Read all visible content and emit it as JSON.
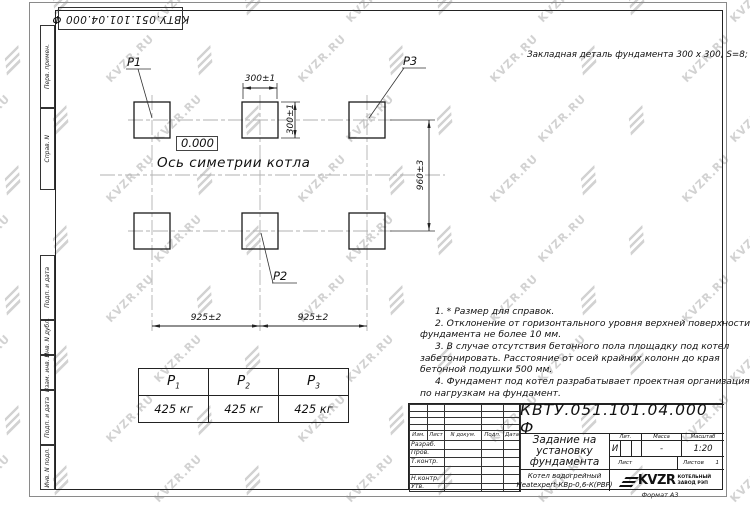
{
  "sheet": {
    "watermark": "KVZR.RU",
    "format": "Формат А3"
  },
  "top_stamp": "КВТУ.051.101.04.000  Ф",
  "margins": {
    "top": [
      "Перв. примен.",
      "Справ. N"
    ],
    "bottom": [
      "Подп. и дата",
      "Инв. N дубл.",
      "Взам. инв. N",
      "Подп. и дата",
      "Инв. N подл."
    ]
  },
  "drawing": {
    "header_note": "Закладная деталь фундамента  300 x 300,  S=8;",
    "elevation": "0.000",
    "axis_label": "Ось симетрии котла",
    "p1": "P1",
    "p2": "P2",
    "p3": "P3",
    "dim_pad_width": "300±1",
    "dim_pad_height": "300±1",
    "dim_rows": "960±3",
    "dim_col_left": "925±2",
    "dim_col_right": "925±2"
  },
  "load_table": {
    "headers": [
      {
        "b": "P",
        "s": "1"
      },
      {
        "b": "P",
        "s": "2"
      },
      {
        "b": "P",
        "s": "3"
      }
    ],
    "values": [
      "425 кг",
      "425 кг",
      "425 кг"
    ]
  },
  "notes": [
    "1. * Размер для справок.",
    "2. Отклонение от горизонтального уровня верхней поверхности фундамента не более 10 мм.",
    "3. В случае отсутствия бетонного пола площадку под котел забетонировать. Расстояние от осей крайних колонн до края бетонной подушки 500 мм.",
    "4. Фундамент под котел разрабатывает проектная организация по нагрузкам на фундамент."
  ],
  "title_block": {
    "doc_number": "КВТУ.051.101.04.000  Ф",
    "title": "Задание на установку фундамента",
    "product_line1": "Котел водогрейный",
    "product_line2": "Heatexpert-КВр-0,6-К(РВР)",
    "col_izm": "Изм.",
    "col_list": "Лист",
    "col_ndoc": "N докум.",
    "col_podp": "Подп.",
    "col_data": "Дата",
    "row_razrab": "Разраб.",
    "row_prov": "Пров.",
    "row_tkontr": "Т.контр.",
    "row_nkontr": "Н.контр.",
    "row_utv": "Утв.",
    "lit_label": "Лит.",
    "lit_value": "И",
    "mass_label": "Масса",
    "mass_value": "-",
    "scale_label": "Масштаб",
    "scale_value": "1:20",
    "sheet_label": "Лист",
    "sheets_label": "Листов",
    "sheets_count": "1",
    "brand": "KVZR",
    "brand_sub1": "КОТЕЛЬНЫЙ",
    "brand_sub2": "ЗАВОД РЭП"
  }
}
